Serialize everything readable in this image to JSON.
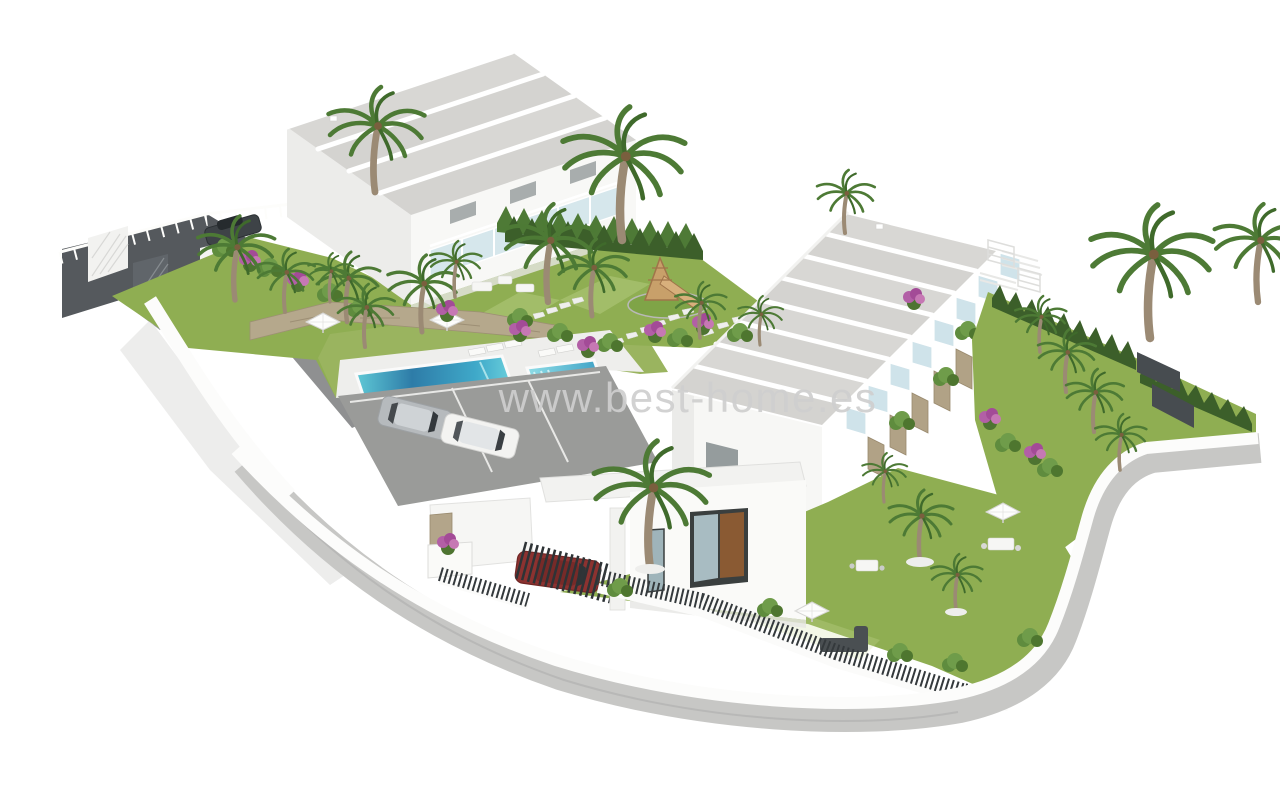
{
  "watermark": {
    "text": "www.best-home.es",
    "color": "#cfcfcf"
  },
  "scene": {
    "type": "3d-architectural-render",
    "subject": "aerial view of a white modern townhouse development with gardens, two swimming pools, parking and perimeter road",
    "background_color": "#ffffff",
    "palette": {
      "roof_gravel": "#d8d7d4",
      "parapet_white": "#ffffff",
      "wall_white": "#f8f8f6",
      "wall_shade": "#e9e9e7",
      "lawn_green": "#8fae52",
      "lawn_light": "#a6bf70",
      "pool_deep_blue": "#2e7ca8",
      "pool_turquoise": "#6fd3de",
      "road_dark_gray": "#55595d",
      "road_light_gray": "#c7c7c5",
      "picket_fence_dark": "#34393c",
      "stone_tan": "#b1a286",
      "palm_frond_green": "#4d7a35",
      "palm_trunk": "#9b8a74",
      "bougainvillea_purple": "#b25fa6",
      "car_silver": "#b6babd",
      "car_white": "#f3f3f1",
      "car_dark": "#3e4347",
      "car_red": "#8c3230",
      "glass_blue": "#d6e7ec"
    },
    "objects": [
      {
        "name": "townhouse-block-back-left",
        "roof_sections": 4,
        "features": "stepped gravel roofs, glass balconies on right end"
      },
      {
        "name": "townhouse-row-right",
        "roof_sections": 8,
        "features": "stepped gravel roofs, glass balconies and stone-walled terrace gardens along front"
      },
      {
        "name": "front-annex-house",
        "features": "glass door with brown panel, front lawn"
      },
      {
        "name": "swimming-pool-large",
        "style": "rectangular, deep blue to turquoise"
      },
      {
        "name": "swimming-pool-small",
        "style": "turquoise with entry steps"
      },
      {
        "name": "parking-area",
        "cars": [
          {
            "color": "silver"
          },
          {
            "color": "white"
          }
        ]
      },
      {
        "name": "car-at-entrance",
        "color": "dark gray"
      },
      {
        "name": "car-at-carport",
        "color": "red",
        "note": "behind bar gate"
      },
      {
        "name": "entrance-gates",
        "count": 2
      },
      {
        "name": "playground",
        "features": "wooden climbing frame with slide on green mat"
      },
      {
        "name": "palm-trees",
        "count": 24
      },
      {
        "name": "parasols",
        "count": 4
      },
      {
        "name": "sun-loungers",
        "count": 5
      },
      {
        "name": "cypress-hedge-rows",
        "count": 4
      },
      {
        "name": "bougainvillea-clusters",
        "count": 11
      },
      {
        "name": "perimeter-road",
        "style": "light gray curving band with white boundary wall"
      },
      {
        "name": "picket-fences",
        "style": "dark vertical bars on white base walls"
      },
      {
        "name": "stepping-stone-paths",
        "count": 3
      }
    ]
  }
}
